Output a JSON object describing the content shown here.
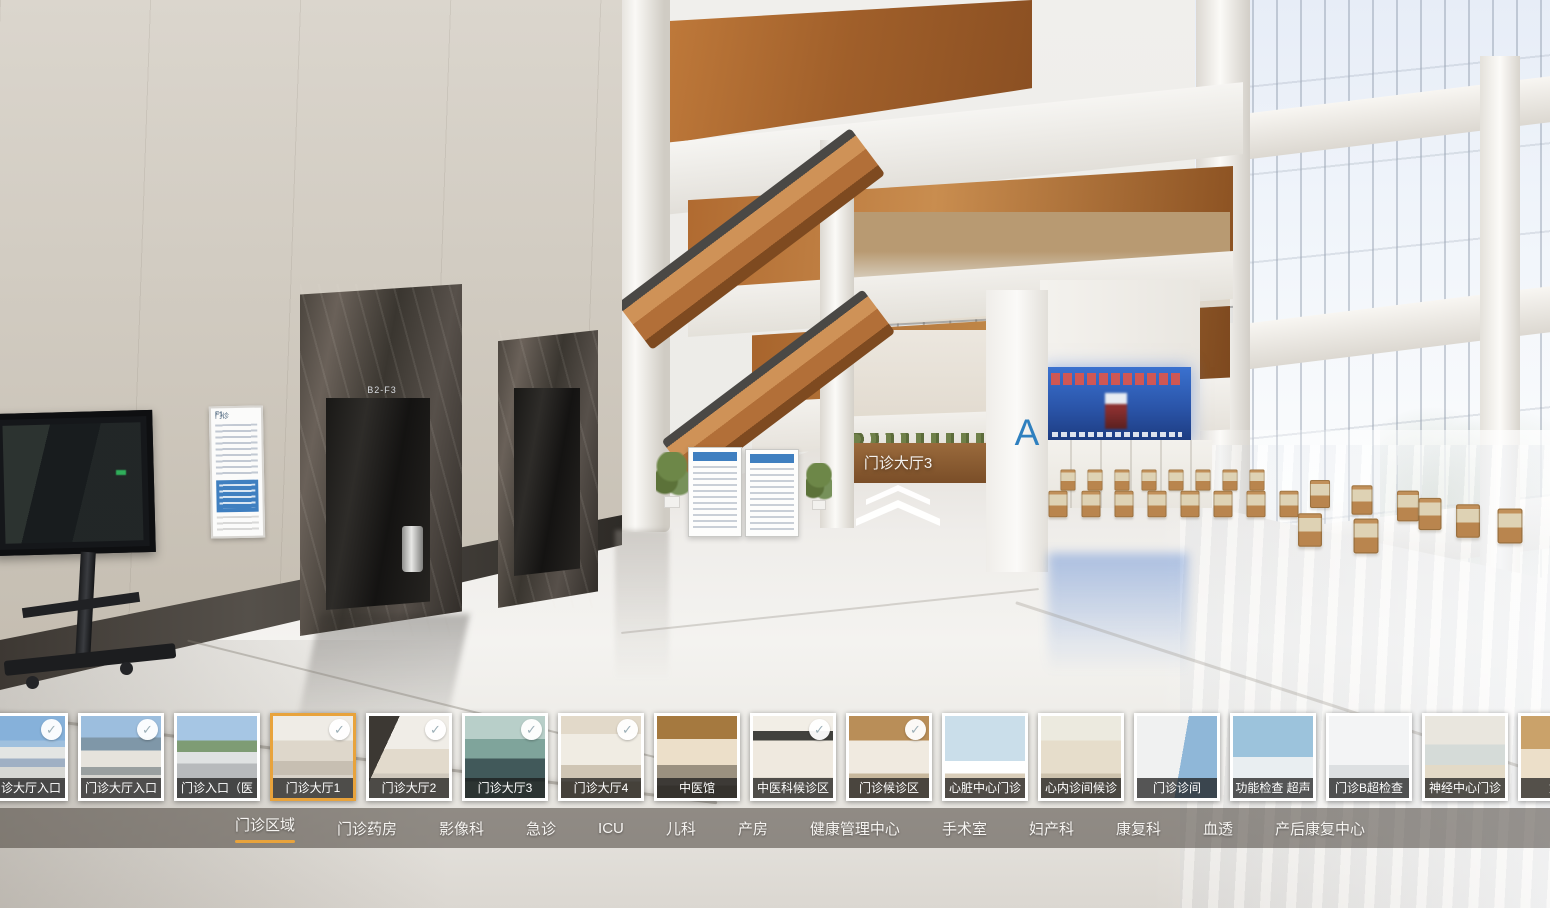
{
  "colors": {
    "accent": "#E8A33C",
    "check_mark": "#9DB0B8",
    "nav_bar": "rgba(73,66,59,0.55)"
  },
  "icons": {
    "check": "✓",
    "hotspot": "chevron-up-double"
  },
  "hotspot": {
    "label": "门诊大厅3"
  },
  "scene": {
    "zone_sign": "A",
    "elevator_sign": "B2-F3",
    "directory_header": "门诊",
    "directory_floor": "F1"
  },
  "thumbnail_strip": {
    "items": [
      {
        "label": "门诊大厅入口",
        "checked": true,
        "selected": false,
        "scene": "ext-building"
      },
      {
        "label": "门诊大厅入口",
        "checked": true,
        "selected": false,
        "scene": "ext-canopy"
      },
      {
        "label": "门诊入口（医",
        "checked": false,
        "selected": false,
        "scene": "ext-road"
      },
      {
        "label": "门诊大厅1",
        "checked": true,
        "selected": true,
        "scene": "lobby-1"
      },
      {
        "label": "门诊大厅2",
        "checked": true,
        "selected": false,
        "scene": "lobby-2"
      },
      {
        "label": "门诊大厅3",
        "checked": true,
        "selected": false,
        "scene": "glass-pool"
      },
      {
        "label": "门诊大厅4",
        "checked": true,
        "selected": false,
        "scene": "lobby-4"
      },
      {
        "label": "中医馆",
        "checked": false,
        "selected": false,
        "scene": "tcm-hall"
      },
      {
        "label": "中医科候诊区",
        "checked": true,
        "selected": false,
        "scene": "tcm-wait"
      },
      {
        "label": "门诊候诊区",
        "checked": true,
        "selected": false,
        "scene": "outpatient-wait"
      },
      {
        "label": "心脏中心门诊",
        "checked": false,
        "selected": false,
        "scene": "heart-center"
      },
      {
        "label": "心内诊间候诊",
        "checked": false,
        "selected": false,
        "scene": "corridor"
      },
      {
        "label": "门诊诊间",
        "checked": false,
        "selected": false,
        "scene": "consult-room"
      },
      {
        "label": "功能检查 超声",
        "checked": false,
        "selected": false,
        "scene": "func-check"
      },
      {
        "label": "门诊B超检查",
        "checked": false,
        "selected": false,
        "scene": "b-ultrasound"
      },
      {
        "label": "神经中心门诊",
        "checked": false,
        "selected": false,
        "scene": "neuro-center"
      },
      {
        "label": "妇产",
        "checked": false,
        "selected": false,
        "scene": "obstetrics"
      }
    ]
  },
  "nav": {
    "active_index": 0,
    "items": [
      "门诊区域",
      "门诊药房",
      "影像科",
      "急诊",
      "ICU",
      "儿科",
      "产房",
      "健康管理中心",
      "手术室",
      "妇产科",
      "康复科",
      "血透",
      "产后康复中心"
    ]
  }
}
